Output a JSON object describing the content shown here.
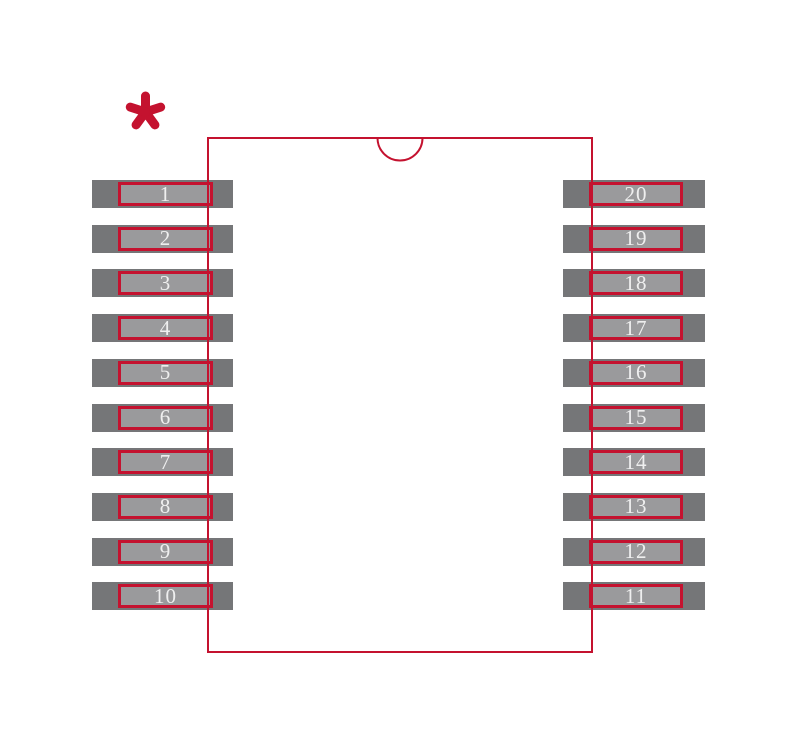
{
  "diagram": {
    "type": "ic-package-land-pattern",
    "pin1_marker_symbol": "*",
    "left_pins": [
      "1",
      "2",
      "3",
      "4",
      "5",
      "6",
      "7",
      "8",
      "9",
      "10"
    ],
    "right_pins": [
      "20",
      "19",
      "18",
      "17",
      "16",
      "15",
      "14",
      "13",
      "12",
      "11"
    ]
  },
  "colors": {
    "background": "#ffffff",
    "outline_red": "#c4122f",
    "pad_outer_gray": "#757678",
    "pad_inner_gray": "#9a9a9c",
    "pin_number_text": "#efefef"
  }
}
